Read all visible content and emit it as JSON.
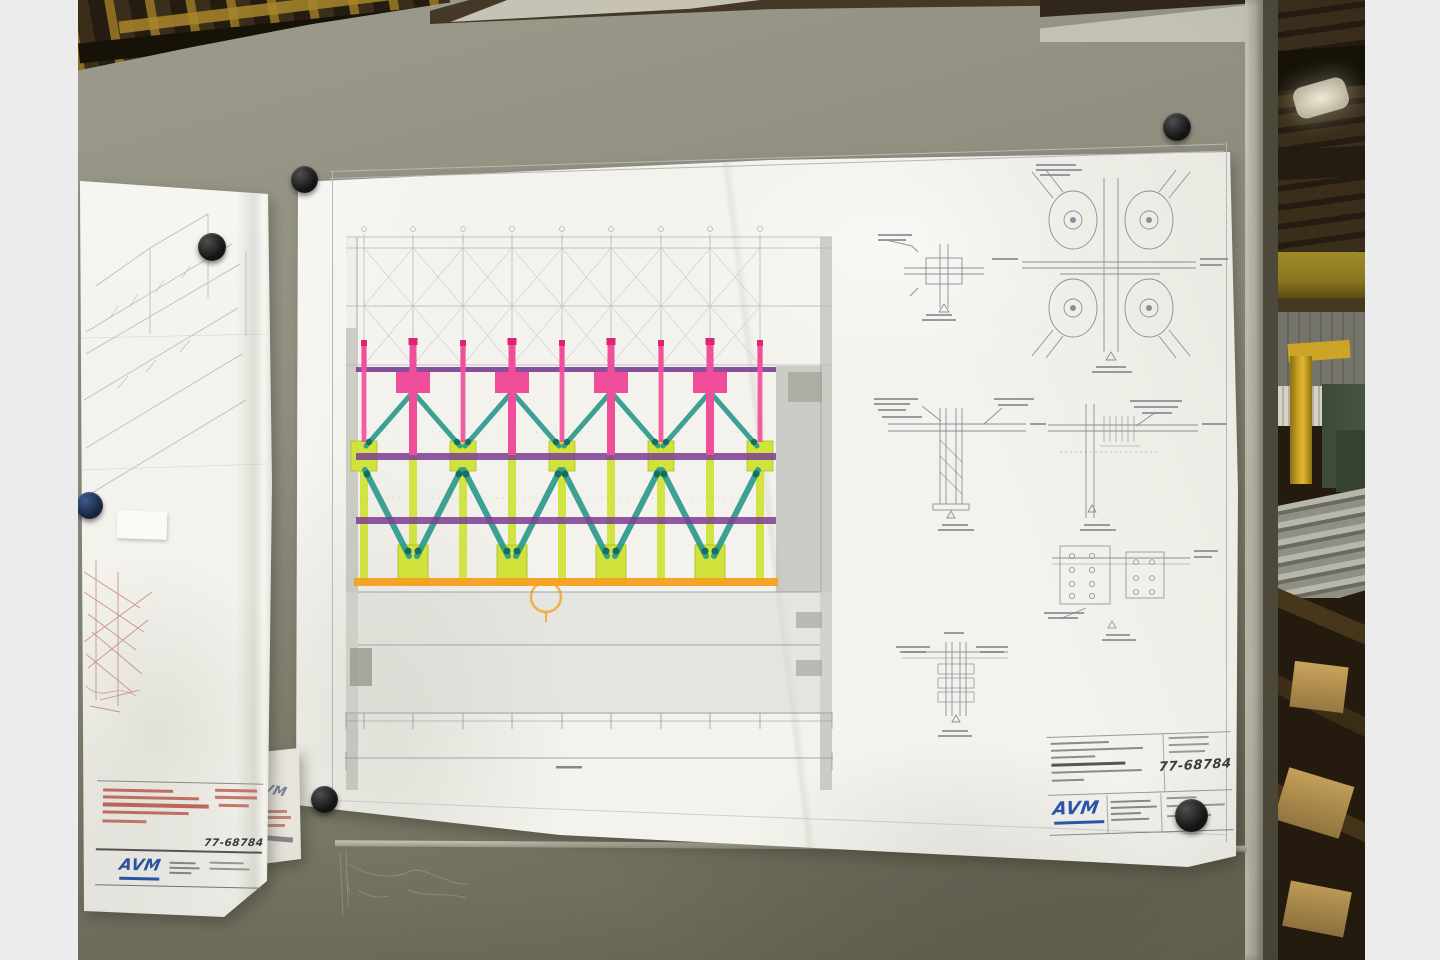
{
  "palette": {
    "letterbox": "#ececec",
    "board_a": "#9a9989",
    "board_b": "#8b8a7a",
    "board_c": "#676553",
    "board_edge_light": "#b4b3a4",
    "board_edge_dark": "#4c483a",
    "seam_light": "#c6c5b6",
    "seam_dark": "#999888",
    "paper": "#f3f2ec",
    "paper_dim": "#e6e4db",
    "paper_shadow": "rgba(45,44,32,0.38)",
    "frame_gray": "#b6b6ba",
    "grid_gray": "#b2b2ba",
    "xbrace_gray": "#c4c4ca",
    "line_gray": "#8d8d98",
    "label_gray": "#8a8a94",
    "shade_gray": "#a6a6a0",
    "lower_gray": "#d8d7d1",
    "block_gray": "#99998f",
    "pink": "#f04d9a",
    "pink_deep": "#dd2470",
    "teal": "#2d9b8c",
    "teal_dark": "#186d61",
    "purple": "#7c3d94",
    "yellow": "#d0e23b",
    "yellow_deep": "#aebf22",
    "orange": "#f3a120",
    "red_ink": "#b9594b",
    "logo_blue": "#2b55a8",
    "ink_dark": "#25252b",
    "corner_text": "#5a6b8c",
    "magnet_hi": "#4f4f4f",
    "magnet_dark": "#141414",
    "magnet_blue_hi": "#3c5a8e",
    "magnet_blue_dark": "#16243e",
    "ceiling_a": "#3a2e1b",
    "ceiling_b": "#241c10",
    "beam_dark": "#171208",
    "streak_yellow": "#8a6d22",
    "streak_bright": "#a8862a",
    "topstrip": "#443927",
    "wedge_light": "#d5d2c4",
    "topedge_light": "#c2c1b2",
    "topedge_dark": "#30271a",
    "crane_a": "#a08a28",
    "crane_b": "#8a7720",
    "crane_c": "#5c4e12",
    "crane_shadow": "#433a20",
    "wall_a": "#75746a",
    "wall_b": "#666558",
    "radiator_a": "#d6d3c6",
    "radiator_b": "#b4b1a2",
    "mach_yellow": "#cda426",
    "mach_yellow_hi": "#e0b62e",
    "mach_yellow_dk": "#8a6f12",
    "green_a": "#3c4a38",
    "green_b": "#465540",
    "green_c": "#35432f",
    "stack_a": "#b7b6ac",
    "stack_b": "#6b6a5f",
    "stack_c": "#908f84",
    "bg_dark": "#241a0e",
    "diag_wood": "#46361a",
    "wood_a": "#caa55c",
    "wood_b": "#9a7a42",
    "lamp_a": "#f0edda",
    "lamp_b": "#bdb8a2",
    "chalk": "#a2a193"
  },
  "sheets": {
    "main": {
      "logo": "AVM",
      "handwritten_number": "77-68784"
    },
    "left": {
      "logo": "AVM",
      "handwritten_number": "77-68784"
    },
    "corner": {
      "logo": "AVM"
    }
  }
}
